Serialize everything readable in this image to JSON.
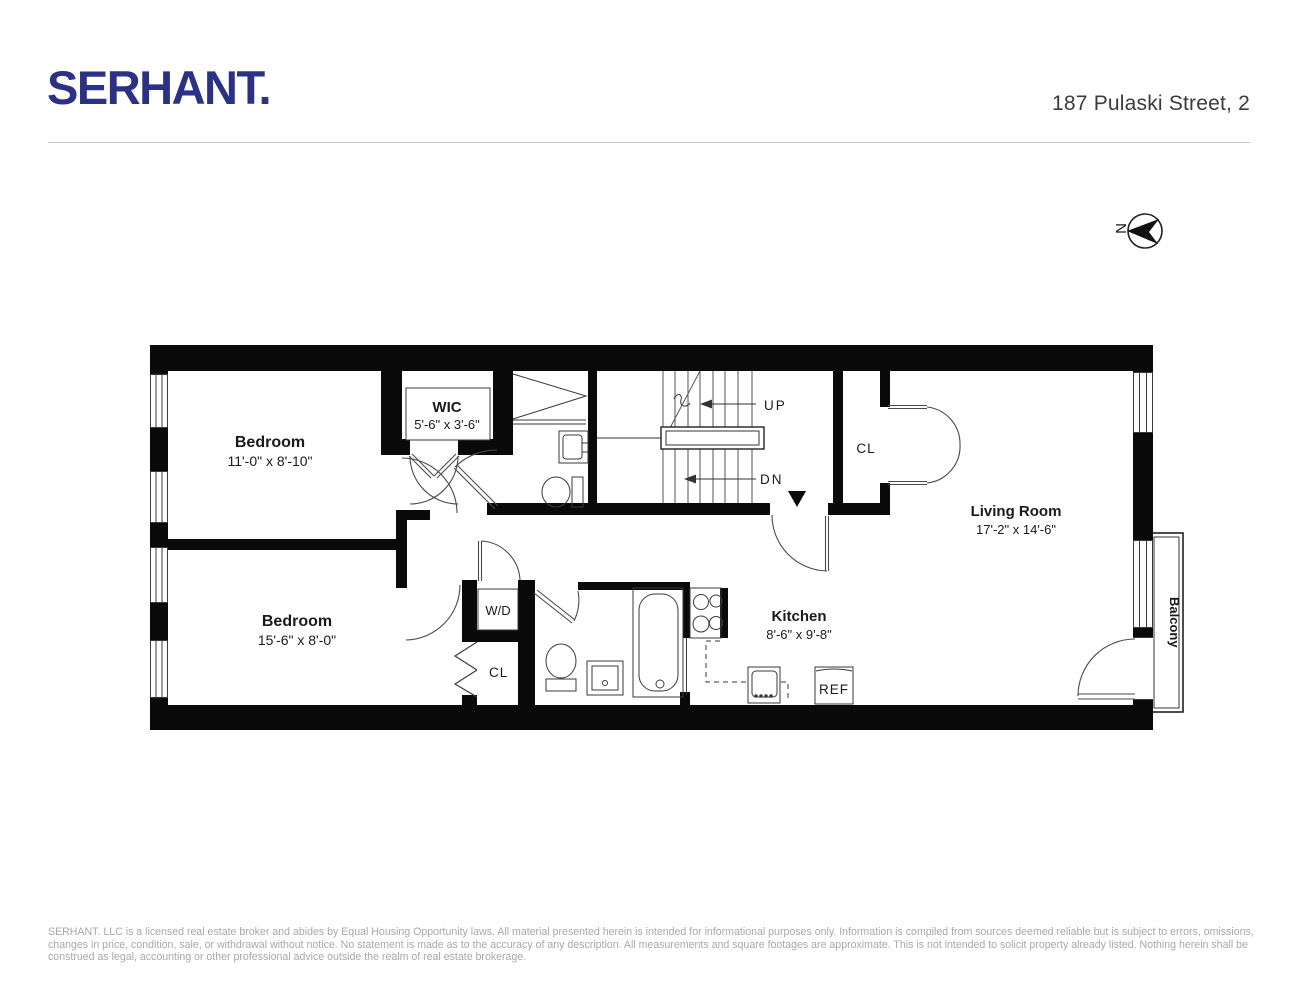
{
  "header": {
    "logo": "SERHANT.",
    "address": "187 Pulaski Street, 2"
  },
  "compass": {
    "north_label": "N"
  },
  "rooms": [
    {
      "name": "Bedroom",
      "dims": "11'-0\" x 8'-10\""
    },
    {
      "name": "WIC",
      "dims": "5'-6\" x 3'-6\""
    },
    {
      "name": "Bedroom",
      "dims": "15'-6\" x 8'-0\""
    },
    {
      "name": "Living Room",
      "dims": "17'-2\" x 14'-6\""
    },
    {
      "name": "Kitchen",
      "dims": "8'-6\" x 9'-8\""
    }
  ],
  "labels": {
    "up": "UP",
    "dn": "DN",
    "closet_top": "CL",
    "closet_bottom": "CL",
    "washer_dryer": "W/D",
    "fridge": "REF",
    "balcony": "Balcony"
  },
  "footer": {
    "disclaimer": "SERHANT. LLC is a licensed real estate broker and abides by Equal Housing Opportunity laws. All material presented herein is intended for informational purposes only. Information is compiled from sources deemed reliable but is subject to errors, omissions, changes in price, condition, sale, or withdrawal without notice. No statement is made as to the accuracy of any description. All measurements and square footages are approximate. This is not intended to solicit property already listed. Nothing herein shall be construed as legal, accounting or other professional advice outside the realm of real estate brokerage."
  },
  "colors": {
    "logo_navy": "#2b3187",
    "wall_black": "#0a0a0a",
    "line_gray": "#3a3a3a",
    "muted_gray": "#a8a8a8"
  }
}
